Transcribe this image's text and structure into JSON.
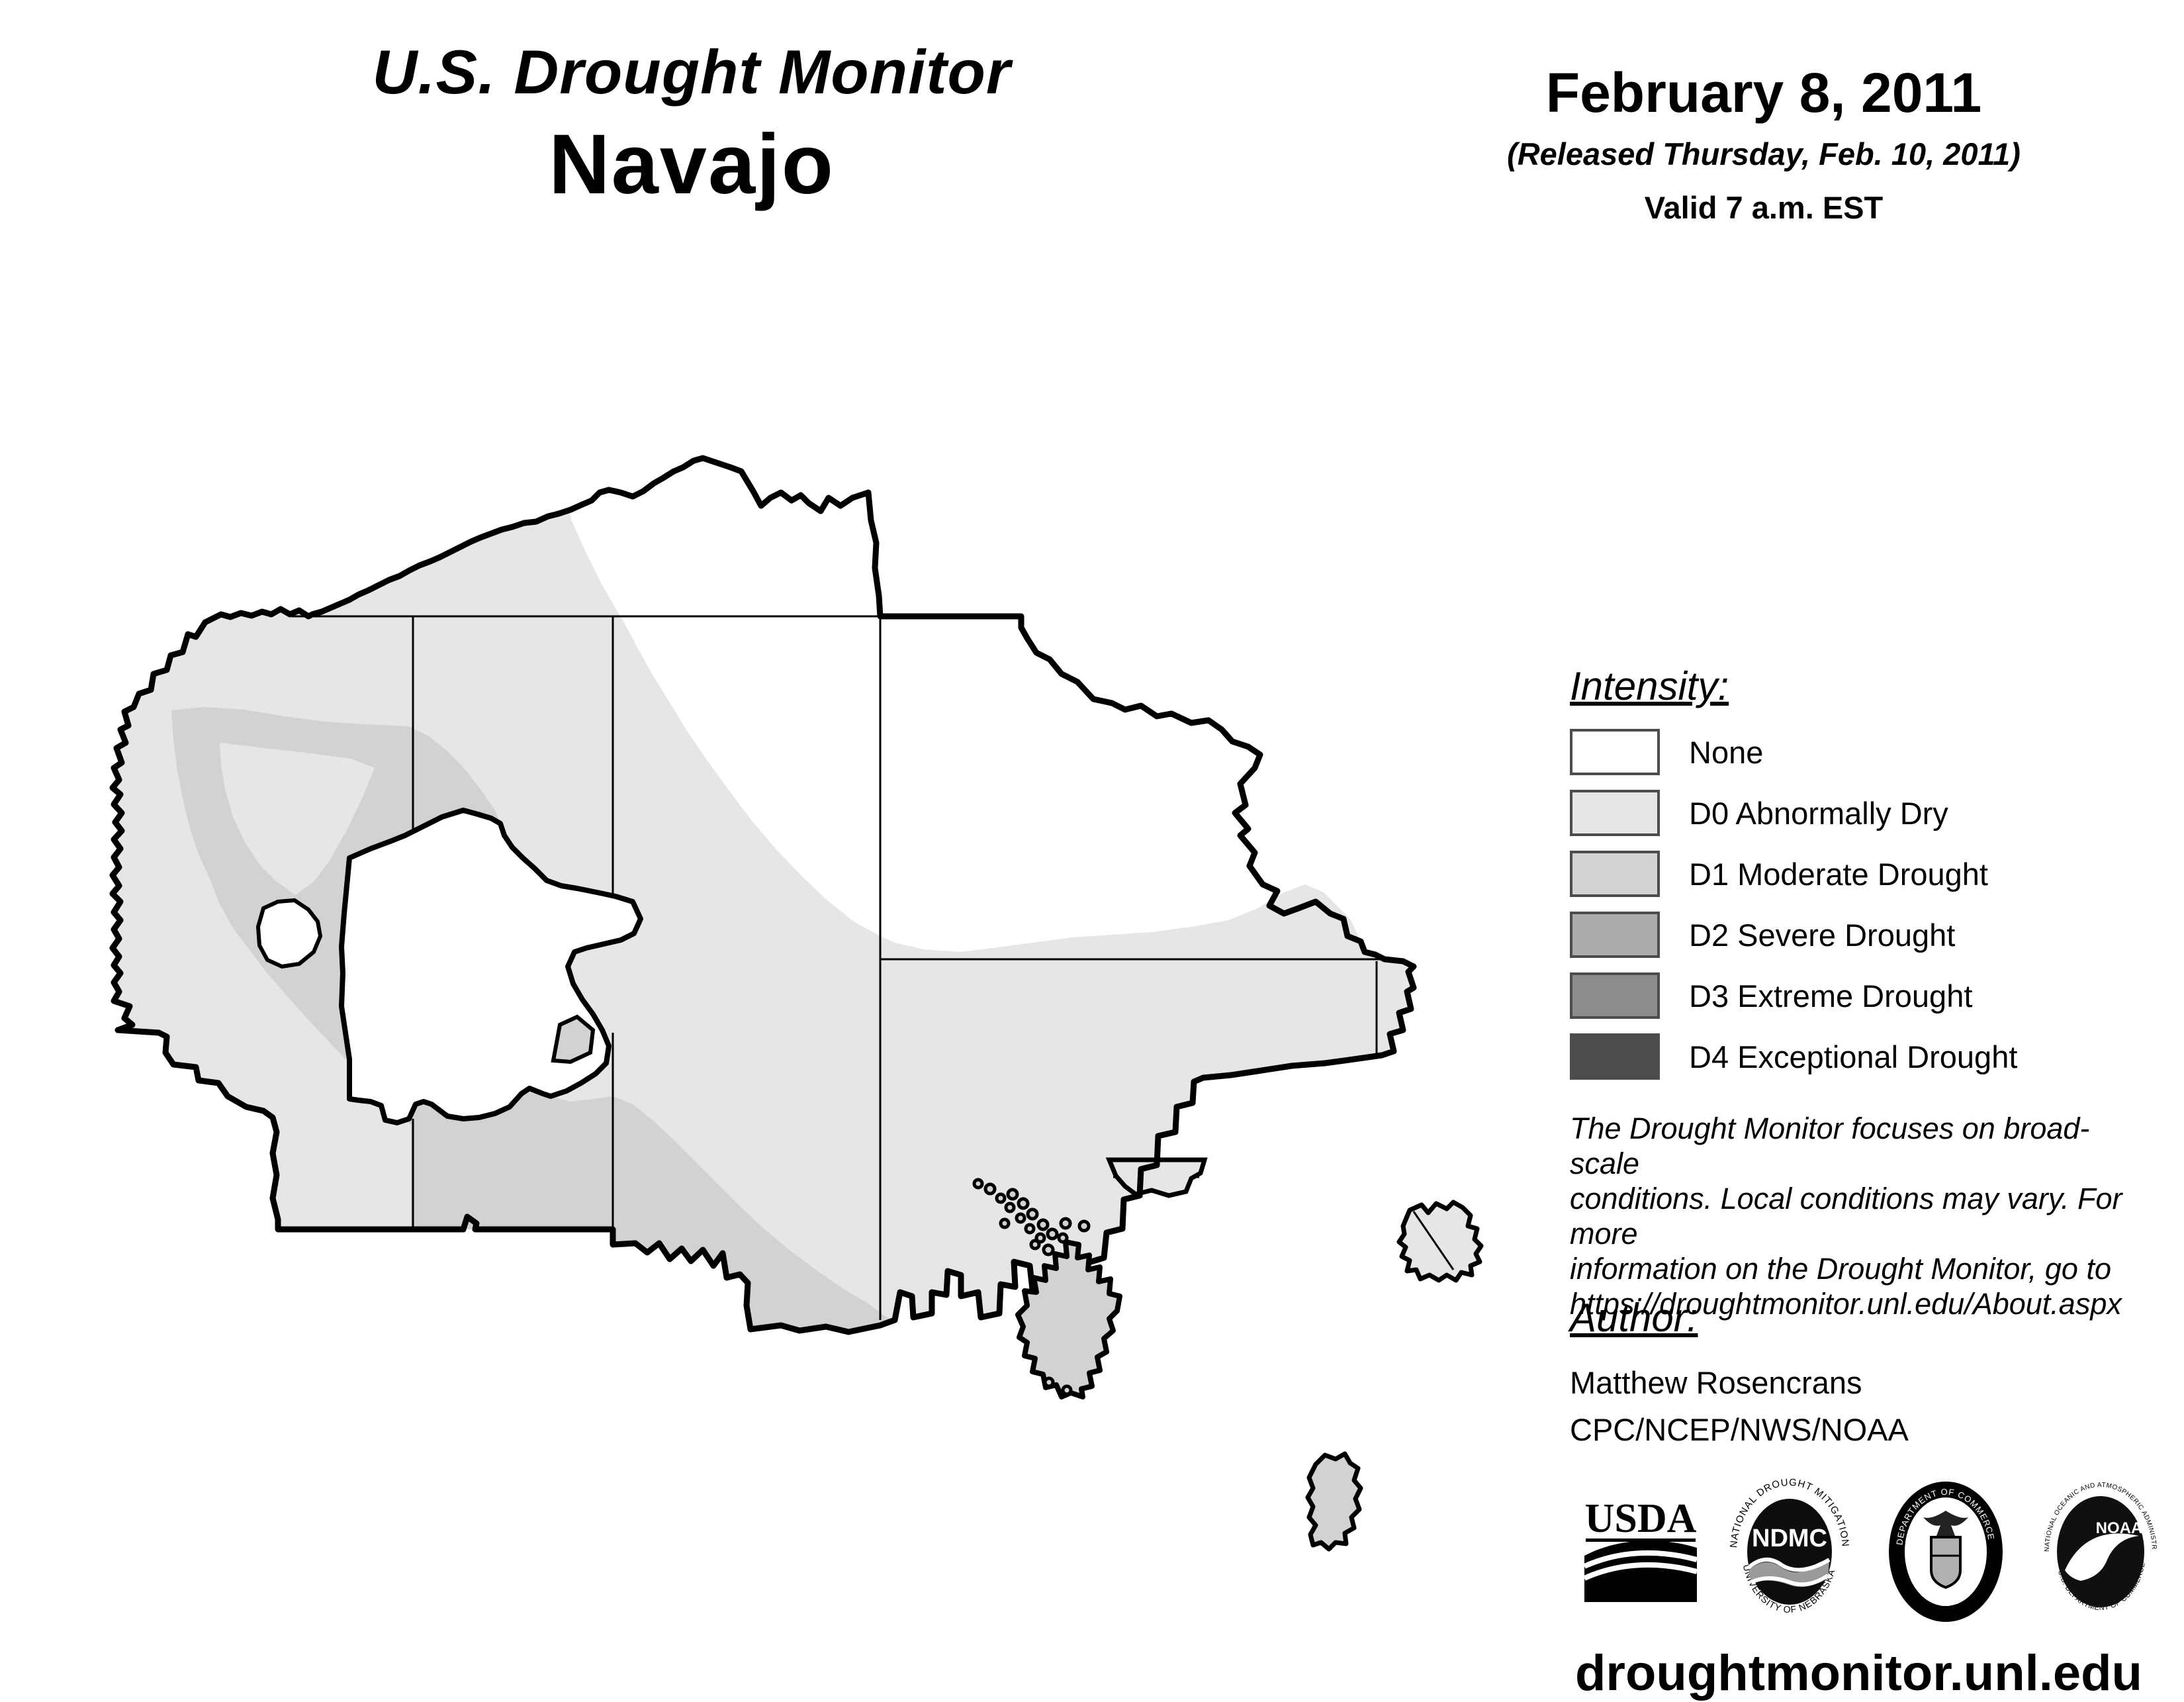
{
  "header": {
    "title": "U.S. Drought Monitor",
    "region": "Navajo"
  },
  "date_block": {
    "date": "February 8, 2011",
    "released": "(Released Thursday, Feb. 10, 2011)",
    "valid": "Valid 7 a.m. EST"
  },
  "legend": {
    "heading": "Intensity:",
    "items": [
      {
        "label": "None",
        "color": "#ffffff"
      },
      {
        "label": "D0 Abnormally Dry",
        "color": "#e6e6e6"
      },
      {
        "label": "D1 Moderate Drought",
        "color": "#d2d2d2"
      },
      {
        "label": "D2 Severe Drought",
        "color": "#ababab"
      },
      {
        "label": "D3 Extreme Drought",
        "color": "#8c8c8c"
      },
      {
        "label": "D4 Exceptional Drought",
        "color": "#4d4d4d"
      }
    ]
  },
  "disclaimer": {
    "lines": [
      "The Drought Monitor focuses on broad-scale",
      "conditions. Local conditions may vary. For more",
      "information on the Drought Monitor, go to",
      "https://droughtmonitor.unl.edu/About.aspx"
    ]
  },
  "author_block": {
    "heading": "Author:",
    "name": "Matthew Rosencrans",
    "org": "CPC/NCEP/NWS/NOAA"
  },
  "footer": {
    "url": "droughtmonitor.unl.edu",
    "logos": {
      "usda": {
        "text": "USDA"
      },
      "ndmc": {
        "text": "NDMC",
        "ring_top": "NATIONAL DROUGHT MITIGATION CENTER",
        "ring_bottom": "UNIVERSITY OF NEBRASKA"
      },
      "doc": {
        "ring_top": "DEPARTMENT OF COMMERCE",
        "ring_bottom": "UNITED STATES OF AMERICA"
      },
      "noaa": {
        "text": "NOAA",
        "ring_top": "NATIONAL OCEANIC AND ATMOSPHERIC ADMINISTRATION",
        "ring_bottom": "U.S. DEPARTMENT OF COMMERCE"
      }
    }
  },
  "map": {
    "region_name": "Navajo Nation",
    "fills": {
      "none": "#ffffff",
      "d0": "#e6e6e6",
      "d1": "#d2d2d2"
    }
  }
}
